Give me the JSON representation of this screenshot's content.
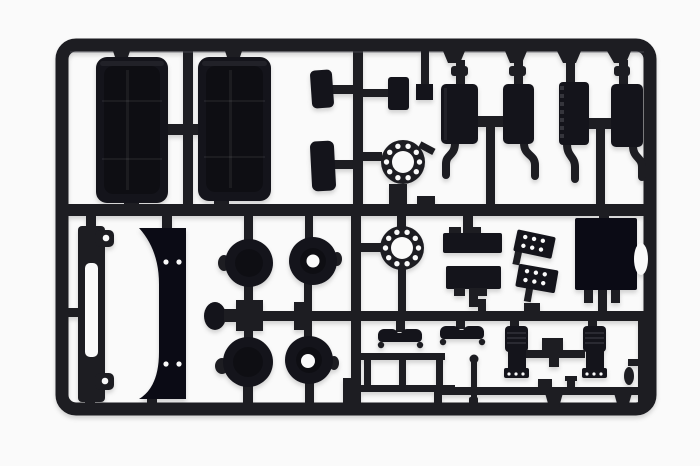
{
  "scene": {
    "description": "Photograph of a black injection-molded plastic model kit sprue (parts tree) for a truck kit, shown on a plain white background",
    "object_type": "model-kit-sprue",
    "material": "black styrene plastic"
  },
  "colors": {
    "bg": "#fafafa",
    "plastic": "#1d1d22",
    "dark": "#14141b",
    "darker": "#0b0b15",
    "edge": "#55555e"
  },
  "parts": {
    "frame": "rectangular sprue frame runner",
    "mudguard_left": "rear mudguard half, left",
    "mudguard_right": "rear mudguard half, right",
    "mud_flaps": "two curved mud flap panels",
    "top_fitting": "small rectangular fitting and block",
    "flange_front": "drilled ring flange, upper",
    "flange_rear": "drilled ring flange, lower",
    "mufflers": "four exhaust mufflers with curved tail pipes",
    "chassis_strip": "slotted chassis side member with eyelet tabs",
    "bracket_panel": "curved fender bracket panel with four holes",
    "hubs": "wheel hubs and brake drums on axle runner",
    "axle_knob": "round hub cap on runner end",
    "battery_boxes": "two notched battery/tank boxes",
    "step_plates": "two perforated tread step plates",
    "cab_rear_panel": "large cab rear panel with side notch",
    "cab_steps": "two cab entry step brackets",
    "ladder_frame": "ladder-shaped chassis sub frame",
    "gear_lever": "gear lever rod with ball top",
    "seats": "two ribbed cab seats with linking bar",
    "small_fittings": "assorted small fittings on lower runner"
  }
}
